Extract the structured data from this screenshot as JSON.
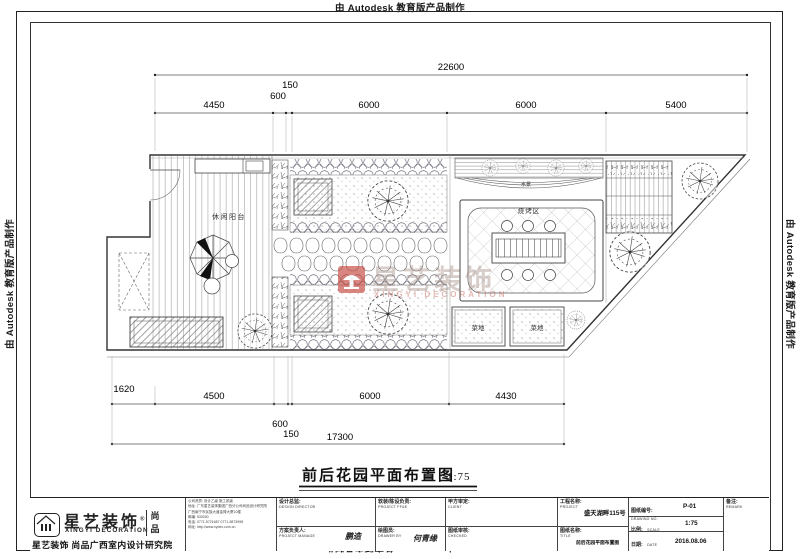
{
  "stamp": {
    "text": "由 Autodesk 教育版产品制作"
  },
  "plan_labels": {
    "balcony": "休闲阳台",
    "water_feature": "水景",
    "bbq_area": "烧烤区",
    "veg_plot_left": "菜地",
    "veg_plot_right": "菜地"
  },
  "dimensions": {
    "top": {
      "overall": "22600",
      "segments": [
        "4450",
        "600",
        "150",
        "6000",
        "6000",
        "5400"
      ]
    },
    "bottom": {
      "segments": [
        "1620",
        "4500",
        "600",
        "150",
        "6000",
        "4430"
      ],
      "overall": "17300"
    }
  },
  "sheet_title": {
    "text": "前后花园平面布置图",
    "scale": "1:75"
  },
  "watermark": {
    "zh": "星艺装饰",
    "en": "XINGYI DECORATION"
  },
  "logo": {
    "brand_zh": "星艺装饰",
    "reg": "®",
    "brand_en": "XINGYI DECORATION",
    "side_text_1": "尚",
    "side_text_2": "品",
    "caption": "星艺装饰 尚品广西室内设计研究院"
  },
  "title_block": {
    "company_lines": [
      "公司资质: 设计乙级 施工贰级",
      "地址: 广东星艺装饰集团广西分公司尚品设计研究院",
      "广西南宁市民族大道金禄大厦10楼",
      "邮编: 530000",
      "电话: 0771-5721687  0771-5873998",
      "网址: http://www.xydec.com.cn"
    ],
    "design_director_zh": "设计总监:",
    "design_director_en": "DESIGN DIRECTOR",
    "project_manager_zh": "方案负责人:",
    "project_manager_en": "PROJECT MANAGE",
    "project_manager_sign": "鹏造",
    "ffe_zh": "软装/陈设负责:",
    "ffe_en": "PROJECT FF&E",
    "drawer_zh": "绘图员:",
    "drawer_en": "DRAWER BY",
    "drawer_sign": "何青缘",
    "client_zh": "甲方审定:",
    "client_en": "CLIENT",
    "checked_zh": "图纸审核:",
    "checked_en": "CHECKED",
    "project_zh": "工程名称:",
    "project_en": "PROJECT",
    "project_value": "盛天湖畔115号",
    "drawing_title_zh": "图纸名称:",
    "drawing_title_en": "TITLE",
    "drawing_title_value": "前后花园平面布置图",
    "drawing_no_zh": "图纸编号:",
    "drawing_no_en": "DRAWING NO.",
    "drawing_no_value": "P-01",
    "scale_zh": "比例:",
    "scale_en": "SCALE",
    "scale_value": "1:75",
    "date_zh": "日期:",
    "date_en": "DATE",
    "date_value": "2016.08.06",
    "remark_zh": "备注:",
    "remark_en": "REMARK"
  }
}
